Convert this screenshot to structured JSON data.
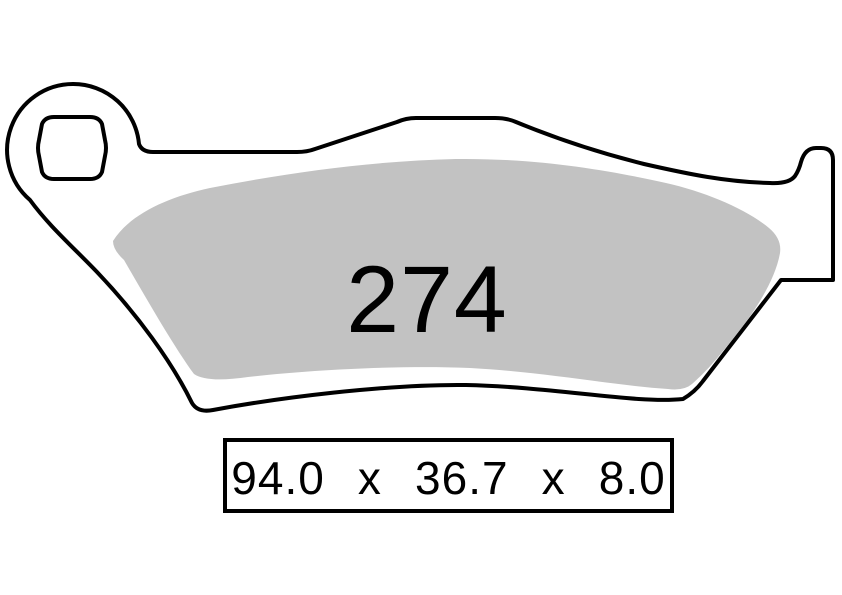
{
  "diagram": {
    "part_number": "274",
    "dimensions_text": "94.0 x 36.7 x 8.0",
    "dimensions": {
      "length": "94.0",
      "width": "36.7",
      "thickness": "8.0",
      "separator": "x"
    },
    "colors": {
      "background": "#ffffff",
      "outline": "#000000",
      "friction_material": "#c2c2c2",
      "label_text": "#000000"
    }
  }
}
